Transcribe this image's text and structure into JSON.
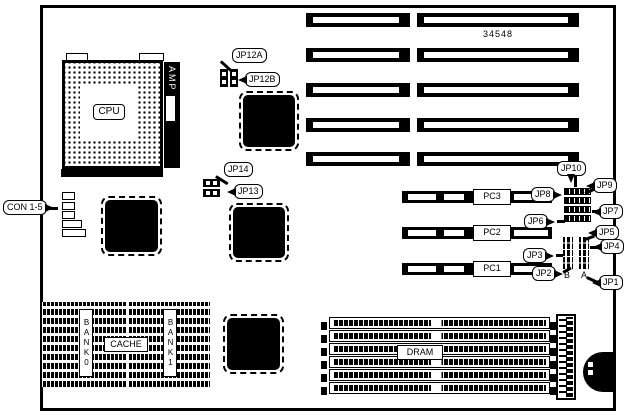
{
  "diagram": {
    "part_number": "34548",
    "cpu": {
      "label": "CPU",
      "socket_brand": "AMP"
    },
    "connectors": {
      "con_group": "CON 1-5"
    },
    "cache": {
      "label": "CACHE",
      "bank0": "BANK0",
      "bank1": "BANK1"
    },
    "dram": {
      "label": "DRAM"
    },
    "pci_slots": {
      "pc1": "PC1",
      "pc2": "PC2",
      "pc3": "PC3"
    },
    "jumpers": {
      "jp1": "JP1",
      "jp2": "JP2",
      "jp3": "JP3",
      "jp4": "JP4",
      "jp5": "JP5",
      "jp6": "JP6",
      "jp7": "JP7",
      "jp8": "JP8",
      "jp9": "JP9",
      "jp10": "JP10",
      "jp12a": "JP12A",
      "jp12b": "JP12B",
      "jp13": "JP13",
      "jp14": "JP14"
    },
    "pin_columns": {
      "b": "B",
      "a": "A"
    },
    "colors": {
      "line": "#000000",
      "background": "#ffffff"
    }
  }
}
